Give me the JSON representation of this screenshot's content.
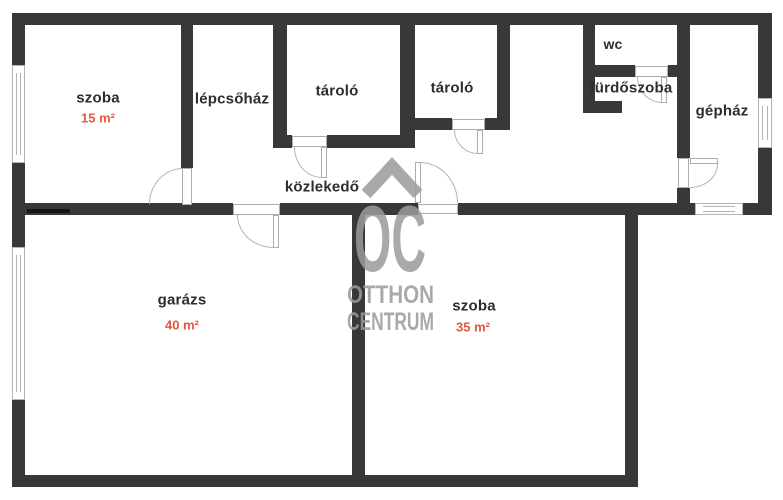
{
  "plan": {
    "rooms": [
      {
        "key": "szoba15",
        "label": "szoba",
        "area": "15 m²"
      },
      {
        "key": "lepcsohaz",
        "label": "lépcsőház",
        "area": ""
      },
      {
        "key": "tarolo1",
        "label": "tároló",
        "area": ""
      },
      {
        "key": "tarolo2",
        "label": "tároló",
        "area": ""
      },
      {
        "key": "wc",
        "label": "wc",
        "area": ""
      },
      {
        "key": "furdoszoba",
        "label": "fürdőszoba",
        "area": ""
      },
      {
        "key": "gephaz",
        "label": "gépház",
        "area": ""
      },
      {
        "key": "kozlekedo",
        "label": "közlekedő",
        "area": ""
      },
      {
        "key": "garazs",
        "label": "garázs",
        "area": "40 m²"
      },
      {
        "key": "szoba35",
        "label": "szoba",
        "area": "35 m²"
      }
    ],
    "watermark": {
      "monogram": "OC",
      "line1": "OTTHON",
      "line2": "CENTRUM"
    },
    "colors": {
      "wall": "#383838",
      "room_text": "#2d2d2d",
      "area_text": "#e25840",
      "watermark": "#9b9b9b"
    }
  }
}
